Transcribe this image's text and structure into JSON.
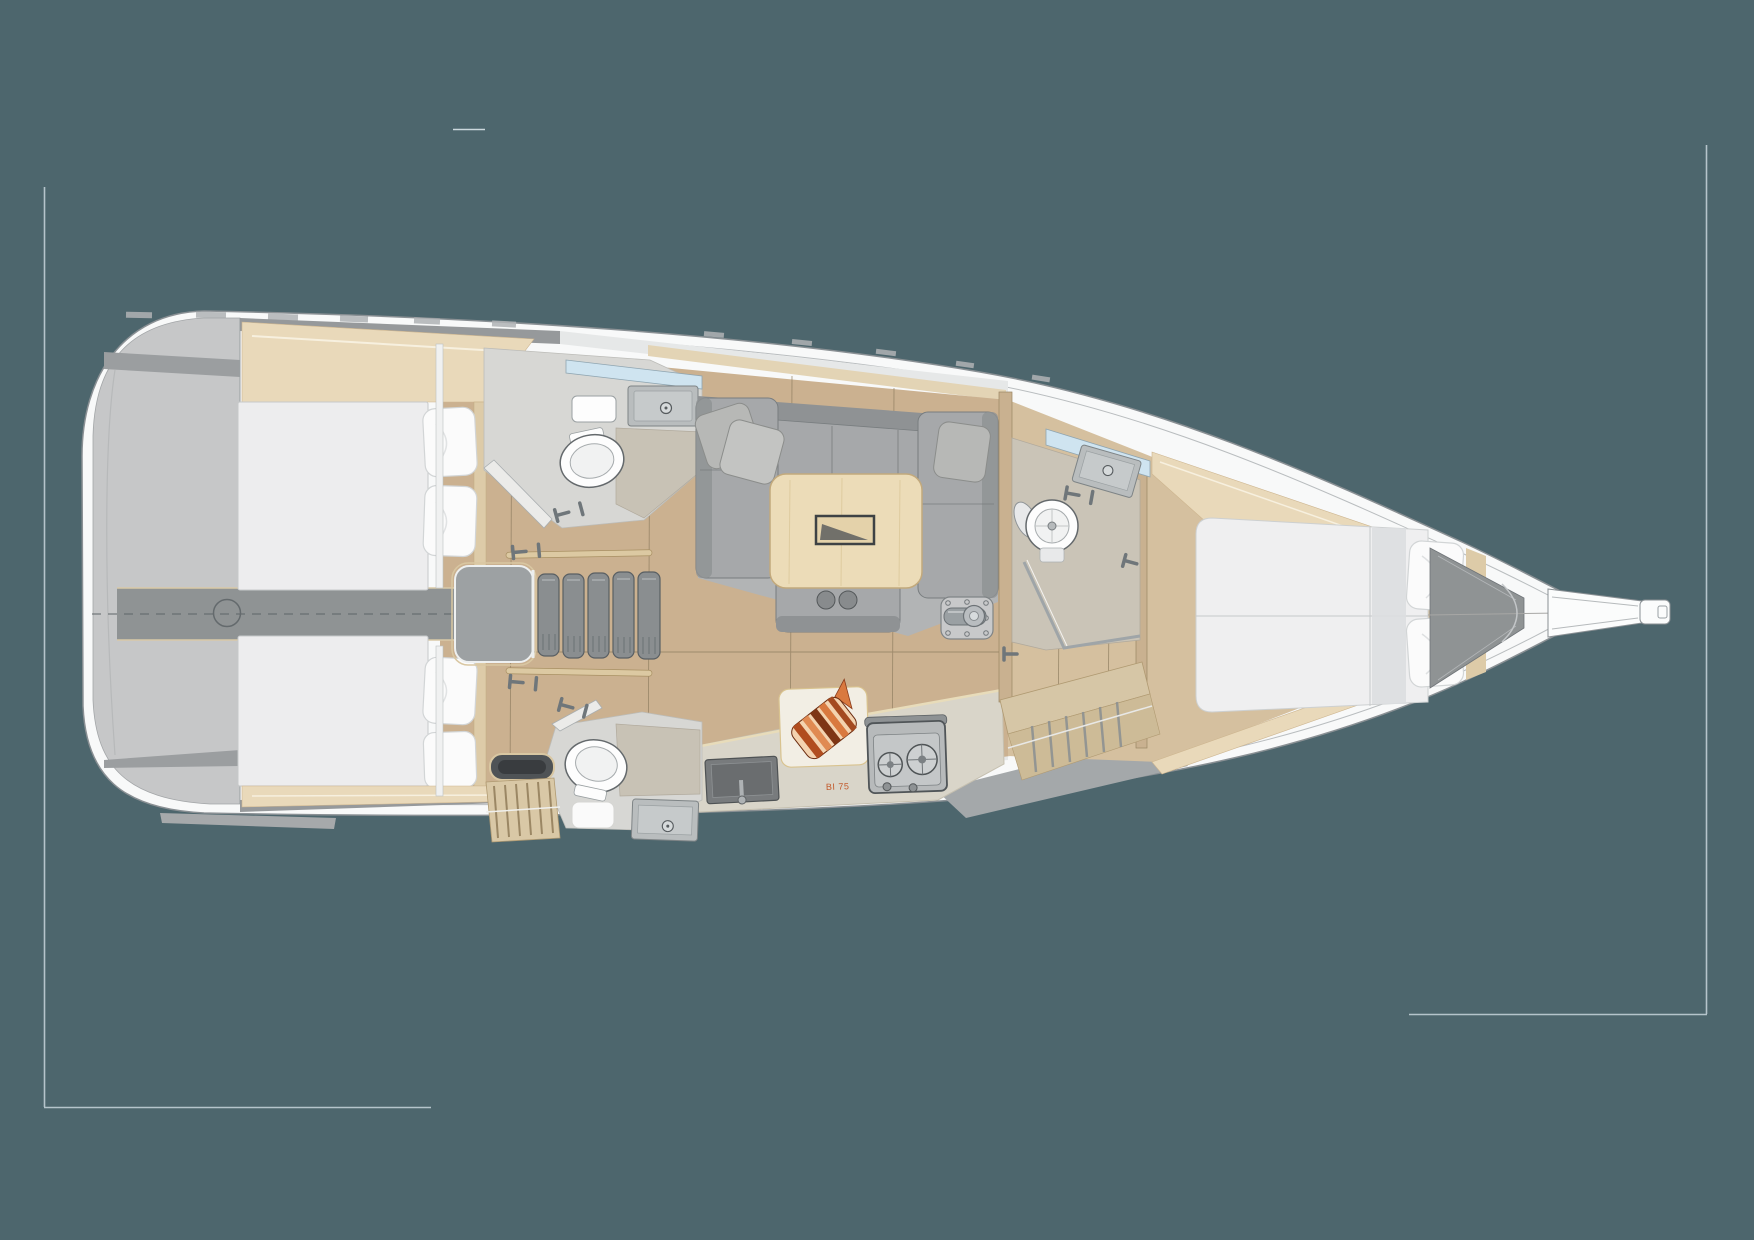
{
  "document": {
    "type": "sailing-yacht-interior-floor-plan",
    "view": "overhead-3d-render",
    "orientation": "bow-right-stern-left"
  },
  "canvas": {
    "width": 1754,
    "height": 1240,
    "background": "#4d666d"
  },
  "palette": {
    "background": "#4d666d",
    "crop_mark": "#b5c4cb",
    "hull_white": "#f8f9f9",
    "hull_line": "#8a9094",
    "deck_gray": "#96999b",
    "transom_gray": "#c6c7c8",
    "wood_floor": "#cbb190",
    "wood_floor_fore": "#d5c09f",
    "shelf_wood": "#e9d9ba",
    "mattress_white": "#ededee",
    "pillow_white": "#fbfbfb",
    "sofa_gray": "#a6a8aa",
    "table_wood": "#ecdcb8",
    "head_floor": "#d7d7d4",
    "shower_floor": "#c8c2b5",
    "window_glass": "#cfe4f0",
    "counter": "#d9d5c9",
    "sink_gray": "#b9bdbe",
    "stove_gray": "#b7babb",
    "engine_strip_gray": "#8f9394",
    "accent_orange": "#c2592a"
  },
  "galley": {
    "label": "BI 75"
  },
  "rooms": [
    {
      "name": "aft-cabin-port",
      "berth": "double",
      "pillows": 2
    },
    {
      "name": "aft-cabin-starboard",
      "berth": "double",
      "pillows": 2
    },
    {
      "name": "aft-head-port",
      "fixtures": [
        "toilet",
        "washbasin",
        "shower"
      ]
    },
    {
      "name": "aft-head-starboard",
      "fixtures": [
        "toilet",
        "washbasin",
        "shower"
      ]
    },
    {
      "name": "salon-dinette",
      "furniture": [
        "u-shaped-sofa",
        "folding-table",
        "pillows"
      ]
    },
    {
      "name": "galley",
      "fixtures": [
        "sink",
        "two-burner-stove",
        "cutting-board"
      ]
    },
    {
      "name": "forward-head",
      "fixtures": [
        "toilet",
        "washbasin",
        "shower-glass"
      ]
    },
    {
      "name": "forward-cabin",
      "berth": "island-double",
      "pillows": 2
    },
    {
      "name": "companionway",
      "steps": 5
    },
    {
      "name": "bow-locker-and-bowsprit"
    }
  ]
}
